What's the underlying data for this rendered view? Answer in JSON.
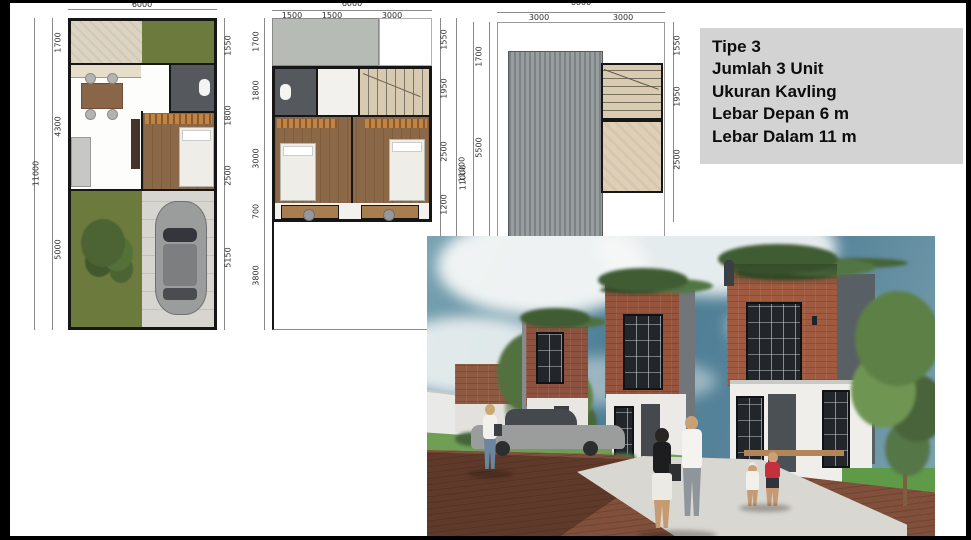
{
  "info_box": {
    "lines": [
      "Tipe 3",
      "Jumlah 3 Unit",
      "Ukuran Kavling",
      "Lebar Depan 6 m",
      "Lebar Dalam 11 m"
    ]
  },
  "plans": [
    {
      "name": "ground-floor-plan",
      "top": {
        "overall": "6000",
        "segments": []
      },
      "left": {
        "overall": "11000",
        "segments": [
          "1700",
          "4300",
          "5000"
        ]
      },
      "right": {
        "overall": "",
        "segments": [
          "1550",
          "1800",
          "2500",
          "5150"
        ]
      }
    },
    {
      "name": "second-floor-plan",
      "top": {
        "overall": "6000",
        "segments": [
          "1500",
          "1500",
          "3000"
        ]
      },
      "left": {
        "overall": "",
        "segments": [
          "1700",
          "1800",
          "3000",
          "700",
          "3800"
        ]
      },
      "right": {
        "overall": "11000",
        "segments": [
          "1550",
          "1950",
          "2500",
          "1200"
        ]
      }
    },
    {
      "name": "roof-plan",
      "top": {
        "overall": "6000",
        "segments": [
          "3000",
          "3000"
        ]
      },
      "left": {
        "overall": "11000",
        "segments": [
          "1700",
          "5500"
        ]
      },
      "right": {
        "overall": "",
        "segments": [
          "1550",
          "1950",
          "2500"
        ]
      }
    }
  ],
  "colors": {
    "info_box_bg": "#d3d3d3",
    "lawn_green": "#6d7a3e",
    "bath_gray": "#55595d",
    "wood_floor": "#8b6847",
    "roof_gray": "#8f9497",
    "sky_blue": "#4f7f93",
    "brick_red": "#a05a40",
    "pavement_brown": "#7d4b39"
  }
}
